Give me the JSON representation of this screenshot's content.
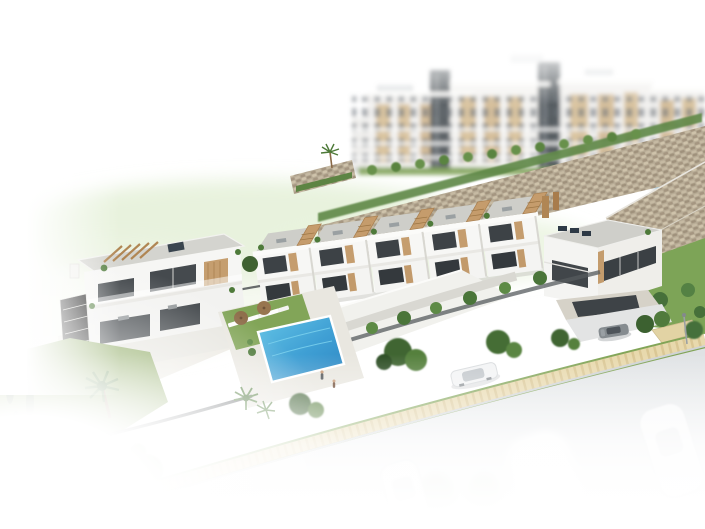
{
  "meta": {
    "description": "Aerial 3D architectural rendering of a modern white residential complex: a terraced row of townhouses with wooden staircases, a corner villa, a duplex villa, a communal swimming pool with sun loungers and parasols, landscaped gardens with palm trees, a tan stone retaining wall, blurred apartment blocks in the background and a curved street with cars fading to white at the image edges."
  },
  "palette": {
    "background": "#ffffff",
    "facade_white": "#f5f5f3",
    "facade_shade": "#e7e6e1",
    "glazing_dark": "#3a3f43",
    "wood_tan": "#c49c6d",
    "roof_gray": "#cecec9",
    "stone_wall": "#b7ab95",
    "pool_blue": "#3f9fd4",
    "lawn_green": "#8aa75e",
    "tree_green": "#3f6532",
    "hedge_green": "#5f8846",
    "path_sand": "#e8d9ad",
    "road_gray": "#dde0e2",
    "fence_dark": "#4a4f52"
  },
  "scene": {
    "background_apartments": {
      "label": "apartment blocks (blurred background)",
      "count": 4
    },
    "stone_wall": {
      "label": "stone retaining wall"
    },
    "townhouse_row": {
      "label": "row of terraced townhouses",
      "count": 5
    },
    "corner_villa": {
      "label": "corner villa with roof terrace"
    },
    "left_villa": {
      "label": "duplex villa with pergola roof deck"
    },
    "pool": {
      "label": "communal swimming pool"
    },
    "loungers": {
      "label": "sun loungers",
      "count": 6
    },
    "umbrellas": {
      "label": "patio parasols",
      "count": 2
    },
    "garden": {
      "label": "landscaped garden with palms and cypresses"
    },
    "sidewalk": {
      "label": "sand-colored paver sidewalk"
    },
    "road": {
      "label": "curved asphalt street fading to white"
    },
    "white_car": {
      "label": "white car on street"
    },
    "gray_car": {
      "label": "gray car at garage driveway"
    },
    "ghost_cars": {
      "label": "faded parked cars",
      "count": 3
    },
    "people": {
      "label": "pedestrians on walkway",
      "count": 2
    },
    "street_lamp": {
      "label": "street lamp"
    },
    "amenity_pool": {
      "label": "small background pool of apartment complex"
    }
  }
}
